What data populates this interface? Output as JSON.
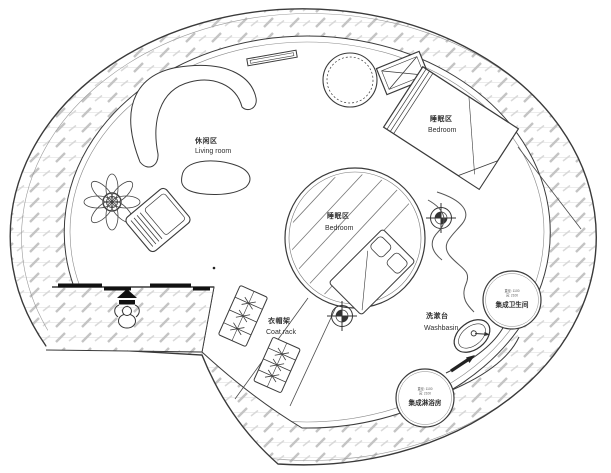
{
  "plan": {
    "areas": {
      "living_room": {
        "zh": "休闲区",
        "en": "Living room"
      },
      "bedroom_upper": {
        "zh": "睡眠区",
        "en": "Bedroom"
      },
      "bedroom_center": {
        "zh": "睡眠区",
        "en": "Bedroom"
      },
      "coat_rack": {
        "zh": "衣帽架",
        "en": "Coat rack"
      },
      "washbasin": {
        "zh": "洗漱台",
        "en": "Washbasin"
      }
    },
    "pods": {
      "bathroom": {
        "name": "集成卫生间",
        "spec_diameter": "直径: 1100",
        "spec_height": "高: 2100"
      },
      "shower": {
        "name": "集成淋浴房",
        "spec_diameter": "直径: 1100",
        "spec_height": "高: 2100"
      }
    },
    "colors": {
      "line": "#3a3a3a",
      "line_light": "#777777",
      "hatch_tick": "#c4c4c4",
      "hatch_line": "#ececec",
      "door": "#111111",
      "text": "#2f2f2f",
      "background": "#ffffff"
    },
    "icons": {
      "entry_arrow": "solid upward entry-direction arrow",
      "person": "top-view person figure at entrance",
      "column_marker": "crosshair column/survey marker",
      "plant": "potted plant",
      "ac_unit": "crossed-box equipment symbol",
      "washbasin": "basin with faucet symbol"
    }
  }
}
